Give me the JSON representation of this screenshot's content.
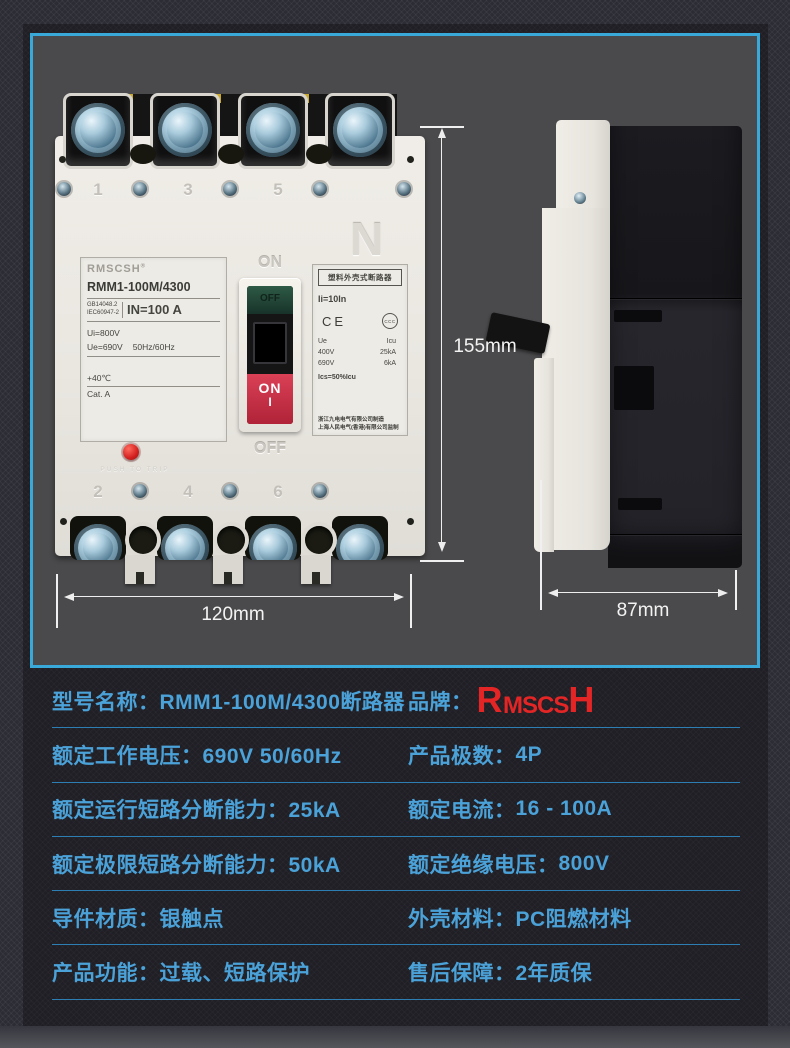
{
  "colors": {
    "accent_cyan": "#38a9d9",
    "table_text": "#4ba2d9",
    "separator": "#2d7eb3",
    "brand_red": "#e42525",
    "photo_background": "#4a4a4c",
    "trip_button_red": "#d32020",
    "handle_red": "#b02338"
  },
  "photo": {
    "dimensions": {
      "height": "155mm",
      "width": "120mm",
      "depth": "87mm"
    },
    "front": {
      "top_terminal_numbers": [
        "1",
        "3",
        "5"
      ],
      "bottom_terminal_numbers": [
        "2",
        "4",
        "6"
      ],
      "neutral_mark": "N",
      "label_left": {
        "brand": "RMSCSH",
        "reg_mark": "®",
        "model": "RMM1-100M/4300",
        "standard_1": "GB14048.2",
        "standard_2": "IEC60947-2",
        "rated_current": "IN=100 A",
        "rated_insulation": "Ui=800V",
        "rated_voltage": "Ue=690V",
        "frequency": "50Hz/60Hz",
        "temperature": "+40℃",
        "category": "Cat. A"
      },
      "switch": {
        "on_embossed": "ON",
        "off_embossed": "OFF",
        "off_window": "OFF",
        "handle_on": "ON",
        "handle_i": "I"
      },
      "trip_button_label": "PUSH TO TRIP",
      "label_right": {
        "title": "塑料外壳式断路器",
        "instantaneous": "Ii=10In",
        "ce_mark": "CE",
        "ccc_mark": "CCC",
        "col_ue": "Ue",
        "col_icu": "Icu",
        "ue_row1": "400V",
        "icu_row1": "25kA",
        "ue_row2": "690V",
        "icu_row2": "6kA",
        "ics": "Ics=50%Icu",
        "manufacturer": "浙江九电电气有限公司制造",
        "supervisor": "上海人民电气(香港)有限公司监制"
      }
    }
  },
  "brand_logo": {
    "part_r": "R",
    "part_mid": "MSCS",
    "part_h": "H"
  },
  "specs": {
    "rows": [
      {
        "left_label": "型号名称：",
        "left_value": "RMM1-100M/4300断路器",
        "right_label": "品牌：",
        "right_value": ""
      },
      {
        "left_label": "额定工作电压：",
        "left_value": "690V 50/60Hz",
        "right_label": "产品极数：",
        "right_value": "4P"
      },
      {
        "left_label": "额定运行短路分断能力：",
        "left_value": "25kA",
        "right_label": "额定电流：",
        "right_value": "16 - 100A"
      },
      {
        "left_label": "额定极限短路分断能力：",
        "left_value": "50kA",
        "right_label": "额定绝缘电压：",
        "right_value": "800V"
      },
      {
        "left_label": "导件材质：",
        "left_value": "银触点",
        "right_label": "外壳材料：",
        "right_value": "PC阻燃材料"
      },
      {
        "left_label": "产品功能：",
        "left_value": "过载、短路保护",
        "right_label": "售后保障：",
        "right_value": "2年质保"
      }
    ]
  }
}
